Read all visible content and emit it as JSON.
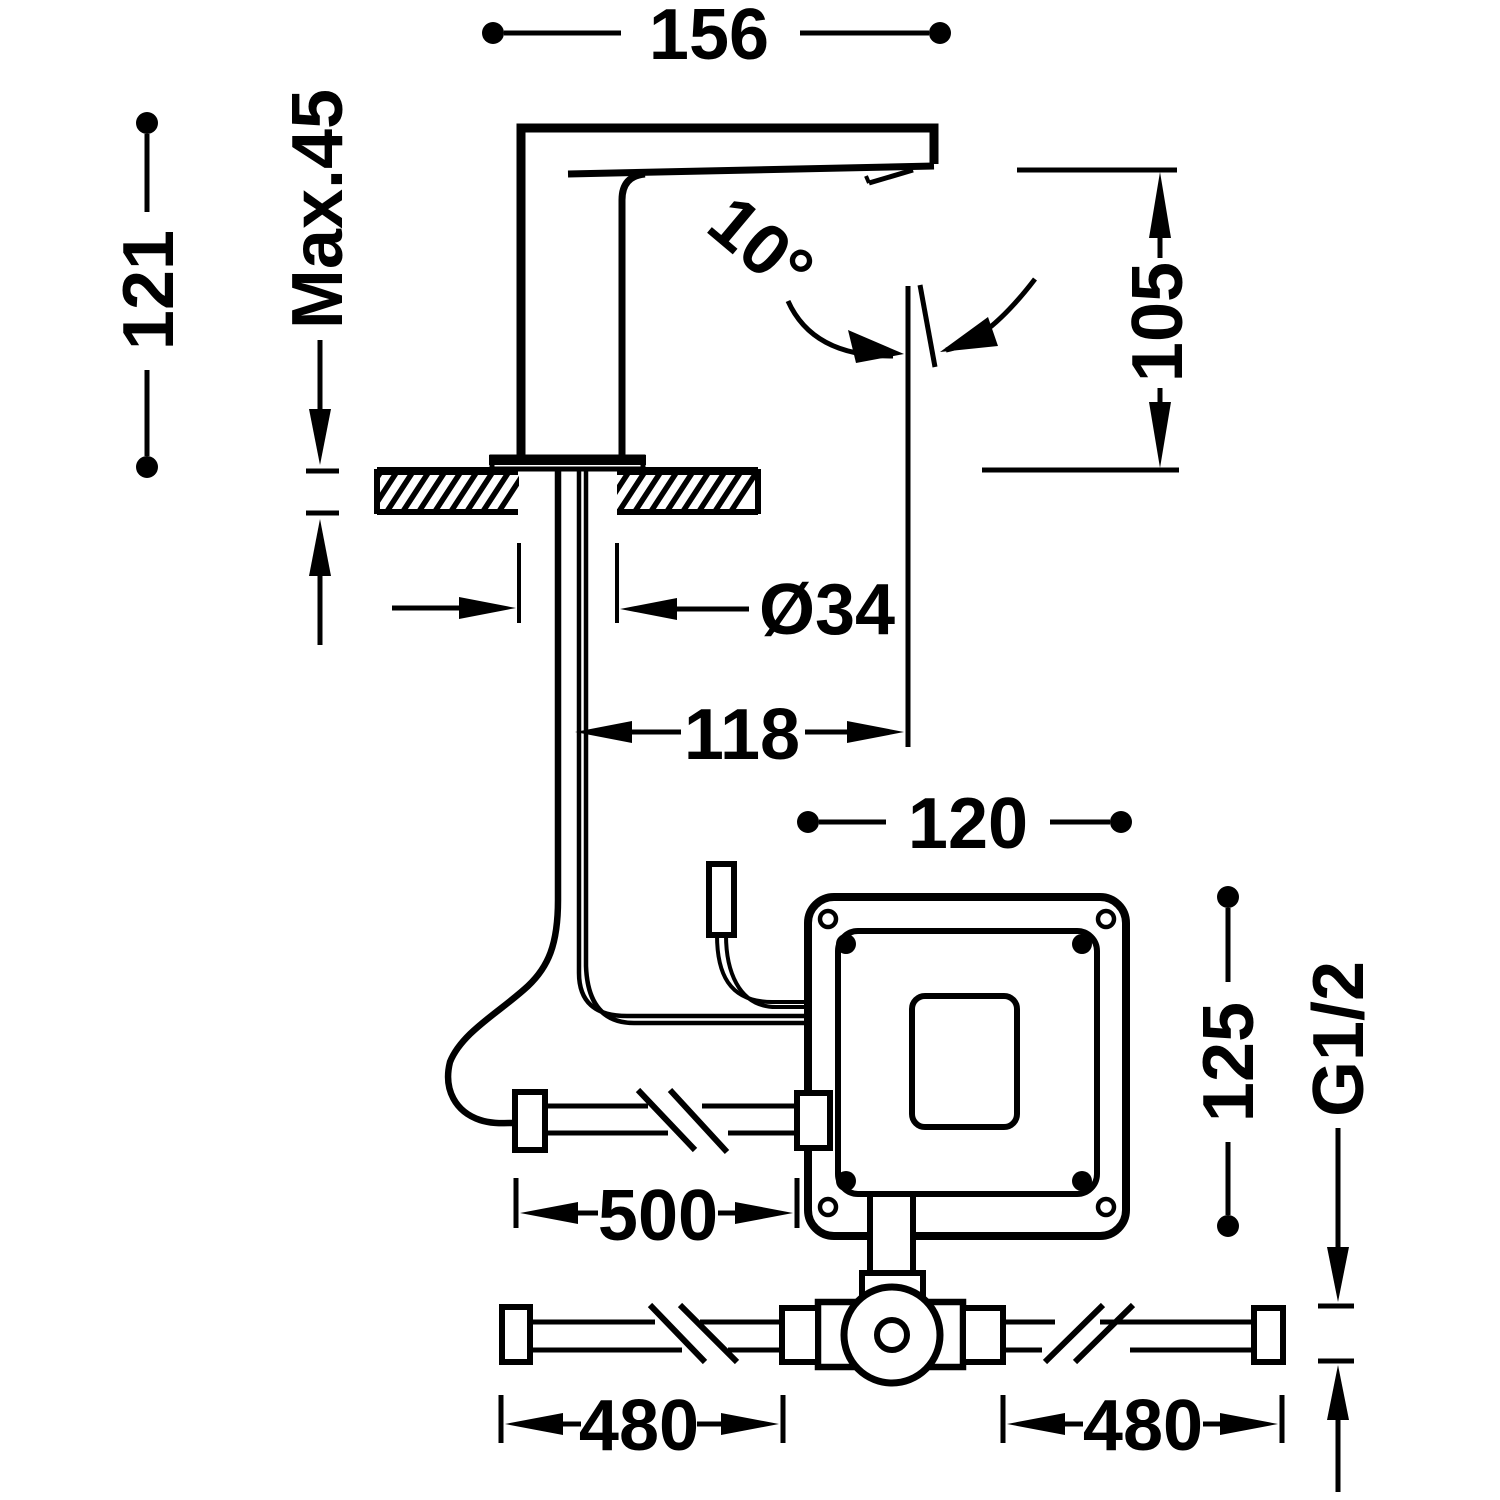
{
  "diagram": {
    "type": "technical-installation-drawing",
    "subject": "deck-mounted electronic sensor faucet with control box and supply pipes",
    "background_color": "#ffffff",
    "ink_color": "#000000",
    "units_shown": "mm",
    "labels": {
      "spout_length": "156",
      "total_height": "121",
      "max_deck_thickness": "Max.45",
      "stream_angle": "10°",
      "outlet_height": "105",
      "hole_diameter": "Ø34",
      "outlet_reach": "118",
      "control_box_width": "120",
      "control_box_height": "125",
      "connection_thread": "G1/2",
      "cable_run_length": "500",
      "supply_pipe_left_length": "480",
      "supply_pipe_right_length": "480"
    }
  }
}
